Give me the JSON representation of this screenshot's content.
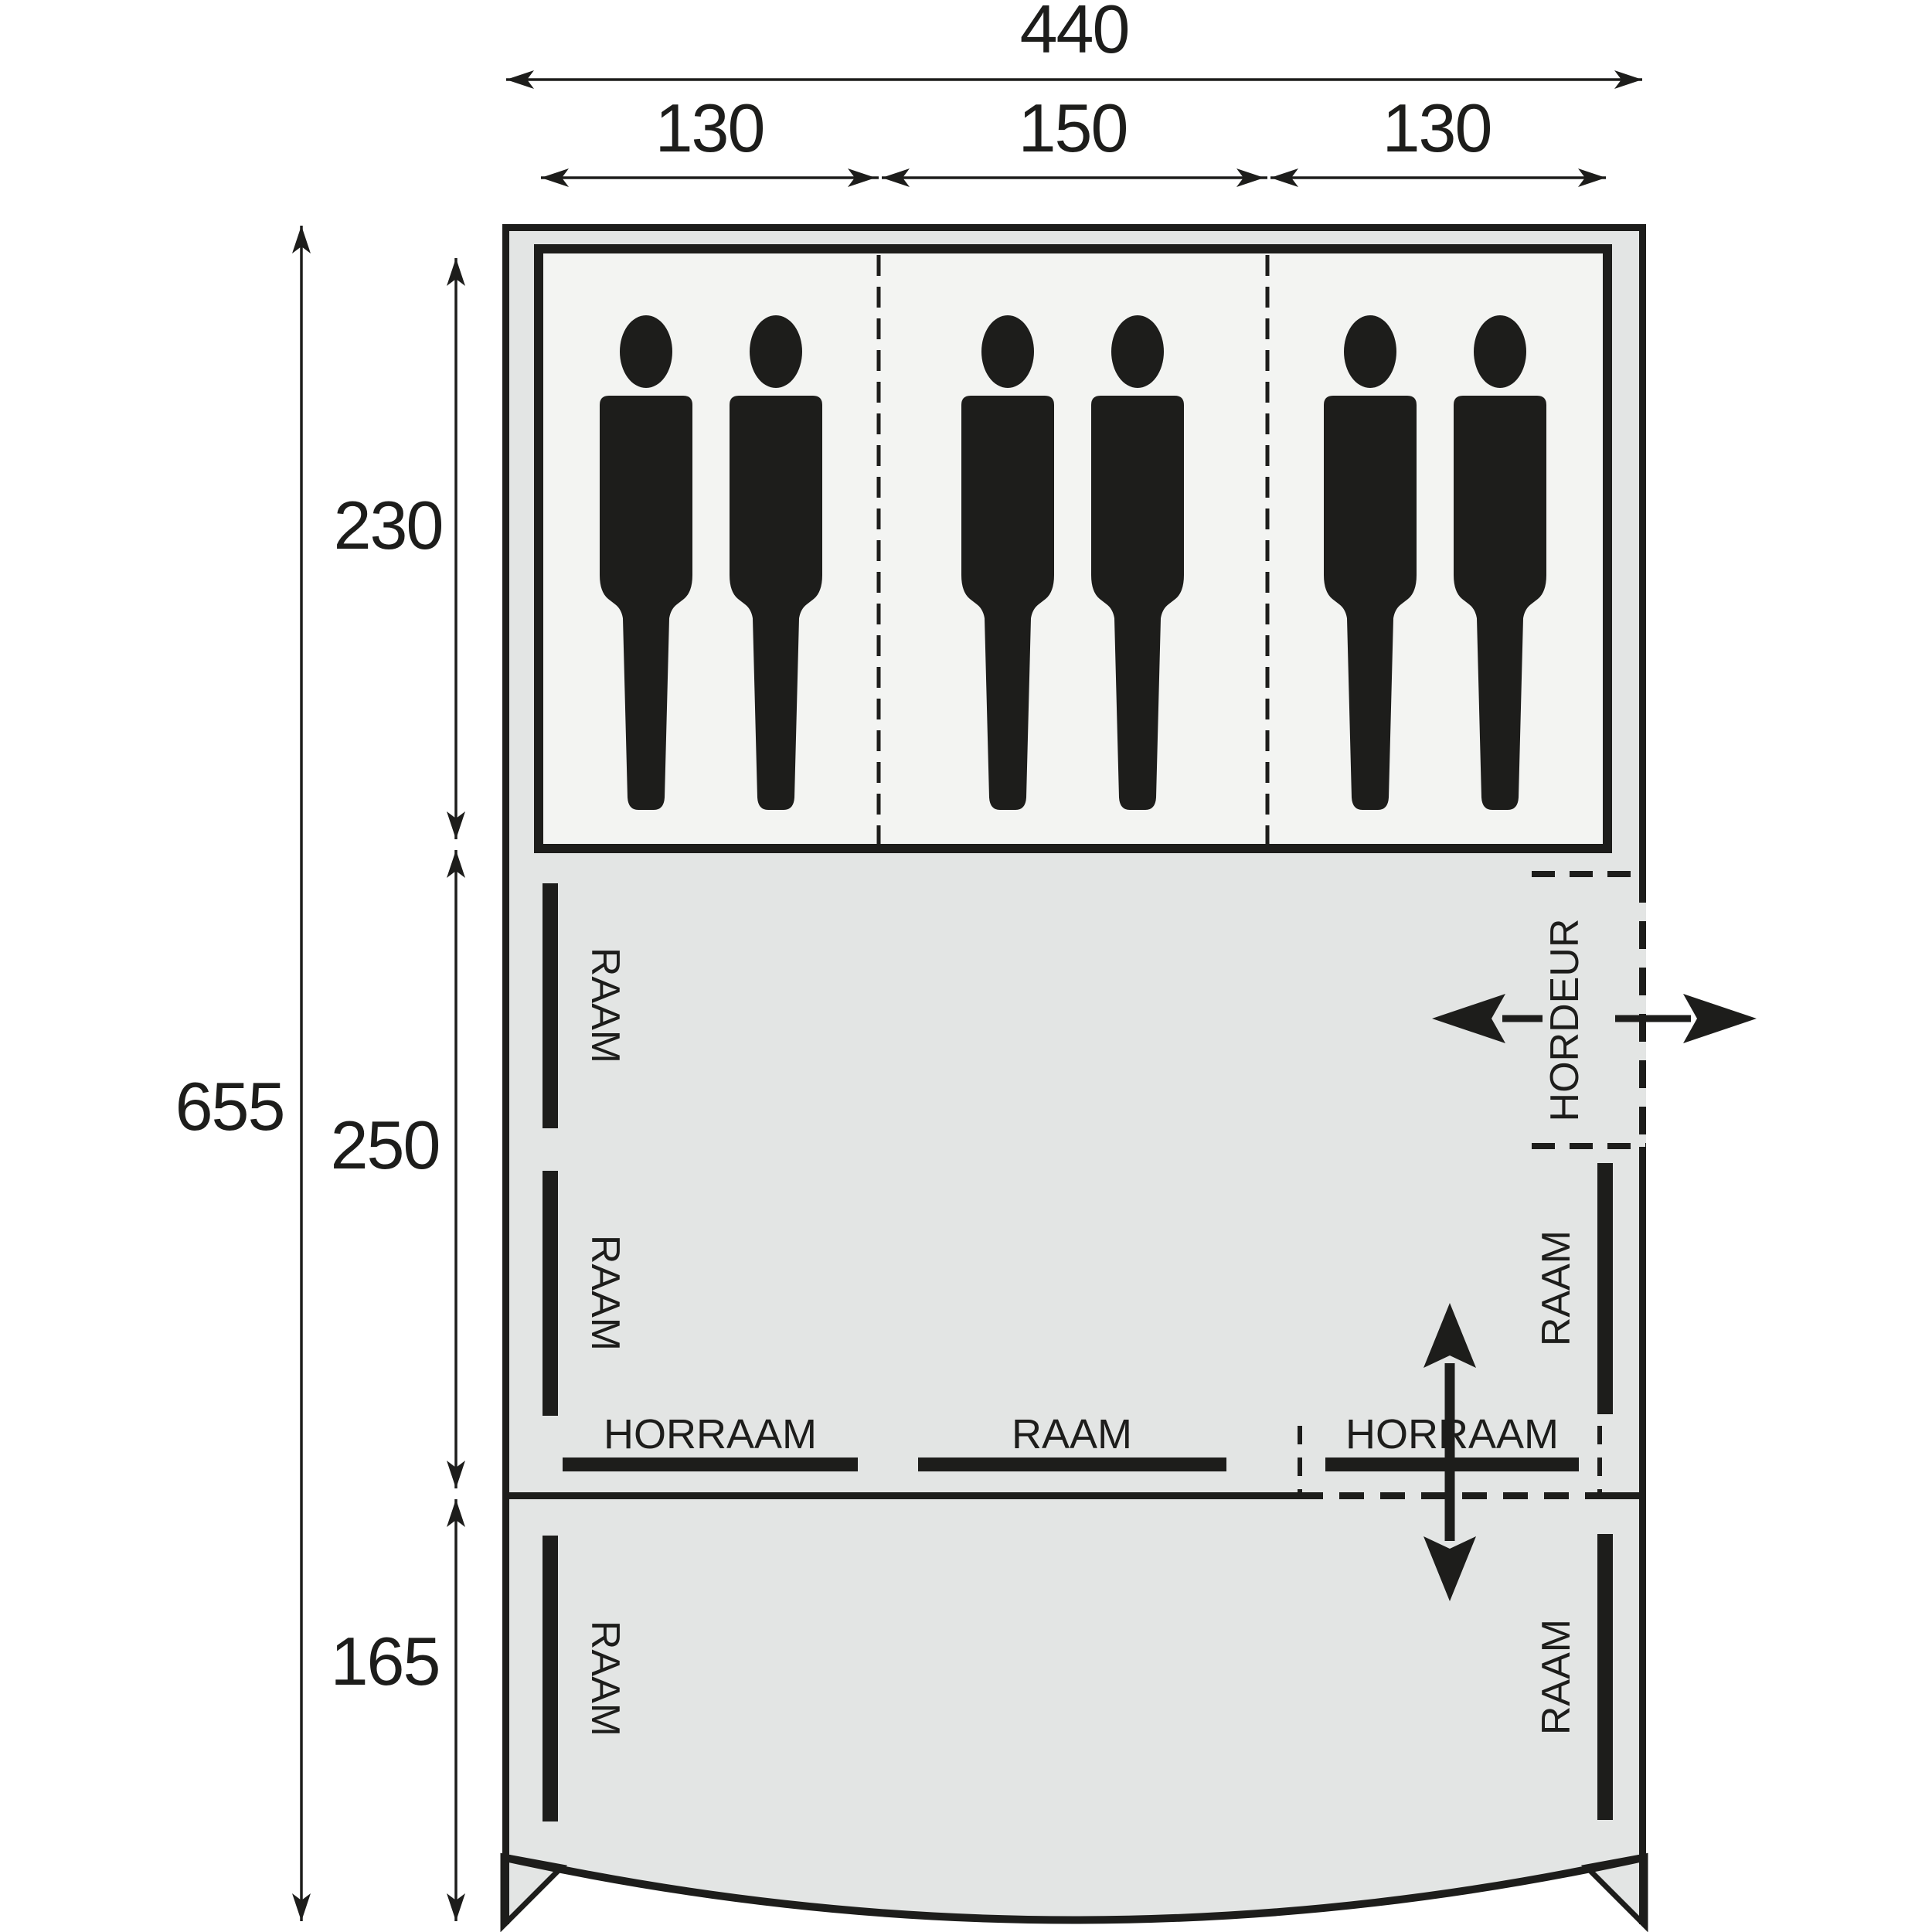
{
  "diagram": {
    "kind": "tent-floorplan-top-view",
    "sleeping_capacity": 6
  },
  "dimensions": {
    "total_width": "440",
    "cabin_left_width": "130",
    "cabin_middle_width": "150",
    "cabin_right_width": "130",
    "total_depth": "655",
    "sleeping_cabin_depth": "230",
    "living_area_depth": "250",
    "porch_depth": "165"
  },
  "labels": {
    "window": "RAAM",
    "mesh_window": "HORRAAM",
    "mesh_door": "HORDEUR"
  },
  "colors": {
    "background": "#ffffff",
    "tent_fill": "#e3e5e4",
    "cabin_fill": "#f3f4f2",
    "ink": "#1d1d1b"
  }
}
